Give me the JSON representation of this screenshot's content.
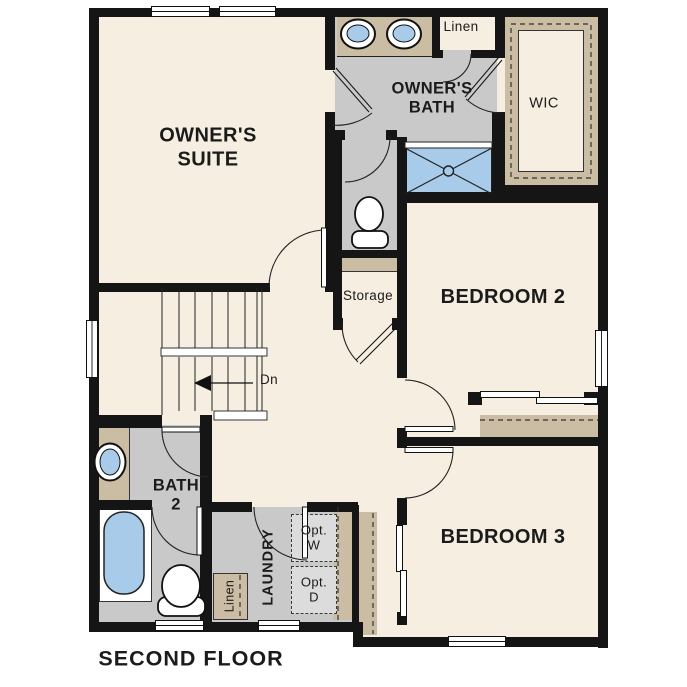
{
  "title": "SECOND FLOOR",
  "colors": {
    "wall": "#151515",
    "floor_cream": "#f5eee1",
    "tile_gray": "#c9c9c9",
    "closet_tan": "#cabda3",
    "fixture_blue": "#a8cbe9",
    "appliance_gray": "#dcdcdc"
  },
  "rooms": {
    "owners_suite": {
      "label": "OWNER'S\nSUITE"
    },
    "owners_bath": {
      "label": "OWNER'S\nBATH"
    },
    "linen_upper": {
      "label": "Linen"
    },
    "wic": {
      "label": "WIC"
    },
    "bedroom2": {
      "label": "BEDROOM 2"
    },
    "storage": {
      "label": "Storage"
    },
    "stairs": {
      "label": "Dn"
    },
    "bath2": {
      "label": "BATH\n2"
    },
    "laundry": {
      "label": "LAUNDRY",
      "washer": "Opt.\nW",
      "dryer": "Opt.\nD",
      "linen": "Linen"
    },
    "bedroom3": {
      "label": "BEDROOM 3"
    }
  },
  "fixtures": [
    "double-vanity-sinks",
    "owner-toilet",
    "walk-in-shower",
    "bath2-sink",
    "bathtub",
    "bath2-toilet",
    "optional-washer",
    "optional-dryer",
    "stairs-down-arrow",
    "linen-closet",
    "walk-in-closet",
    "storage-closet",
    "bedroom2-closet",
    "bedroom3-closet"
  ]
}
